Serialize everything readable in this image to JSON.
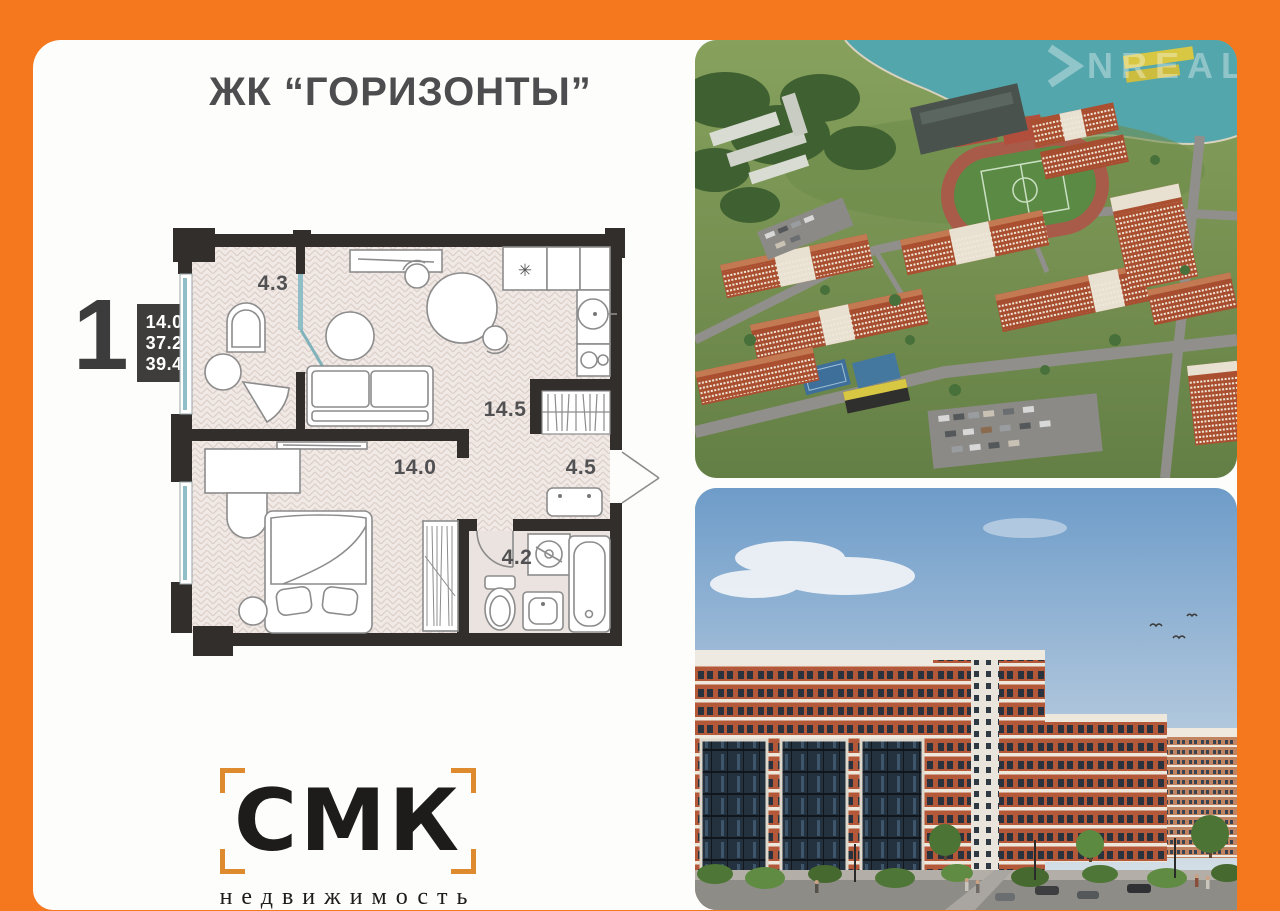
{
  "page": {
    "background_color": "#F5771E",
    "card_color": "#FDFDFB"
  },
  "header": {
    "title": "ЖК “ГОРИЗОНТЫ”"
  },
  "apartment": {
    "rooms_count": "1",
    "area_values": [
      "14.0",
      "37.2",
      "39.4"
    ]
  },
  "floor_plan": {
    "labels": {
      "balcony": "4.3",
      "kitchen_living": "14.5",
      "bedroom": "14.0",
      "hallway": "4.5",
      "bathroom": "4.2"
    },
    "freezer_symbol": "✳",
    "wall_color": "#312E2C",
    "window_color": "#8FBEC6"
  },
  "photos": {
    "top": {
      "kind": "aerial render of residential complex",
      "watermark": "NREAL"
    },
    "bottom": {
      "kind": "street-level render of brick apartment buildings"
    }
  },
  "logo": {
    "name": "СМК",
    "subtitle": "недвижимость",
    "bracket_color": "#DE8A2F"
  }
}
